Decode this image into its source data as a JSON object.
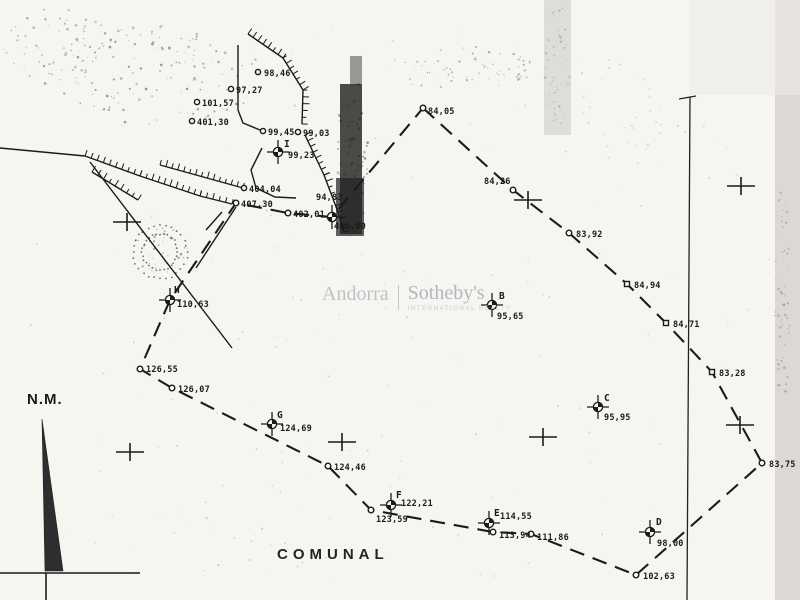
{
  "labels": {
    "north": "N.M.",
    "comunal": "COMUNAL"
  },
  "watermark": {
    "left": "Andorra",
    "right": "Sotheby's",
    "sub": "INTERNATIONAL REALTY"
  },
  "colors": {
    "paper": "#f7f5f0",
    "ink": "#1b1b1b",
    "watermark_gray": "#b6bac4",
    "scan_band_gray": "#d7d5d1",
    "fold_dark": "#1f1f1f"
  },
  "plan": {
    "stations": [
      {
        "id": "I",
        "x": 278,
        "y": 152,
        "lx": 284,
        "ly": 147,
        "value": "99,23",
        "vx": 288,
        "vy": 158
      },
      {
        "id": "B",
        "x": 492,
        "y": 305,
        "lx": 499,
        "ly": 299,
        "value": "95,65",
        "vx": 497,
        "vy": 319
      },
      {
        "id": "C",
        "x": 598,
        "y": 407,
        "lx": 604,
        "ly": 401,
        "value": "95,95",
        "vx": 604,
        "vy": 420
      },
      {
        "id": "D",
        "x": 650,
        "y": 532,
        "lx": 656,
        "ly": 525,
        "value": "98,00",
        "vx": 657,
        "vy": 546
      },
      {
        "id": "E",
        "x": 489,
        "y": 523,
        "lx": 494,
        "ly": 516,
        "value": "114,55",
        "vx": 500,
        "vy": 519
      },
      {
        "id": "F",
        "x": 391,
        "y": 505,
        "lx": 396,
        "ly": 498,
        "value": "122,21",
        "vx": 401,
        "vy": 506
      },
      {
        "id": "G",
        "x": 272,
        "y": 424,
        "lx": 277,
        "ly": 418,
        "value": "124,69",
        "vx": 280,
        "vy": 431
      },
      {
        "id": "H",
        "x": 170,
        "y": 300,
        "lx": 174,
        "ly": 293,
        "value": "110,63",
        "vx": 177,
        "vy": 307
      }
    ],
    "unlettered_station": {
      "x": 332,
      "y": 217,
      "value_above": "94,83",
      "ax": 316,
      "ay": 200,
      "value_below": "460,00",
      "bx": 334,
      "by": 229
    },
    "spot_heights": [
      {
        "x": 258,
        "y": 72,
        "value": "98,46",
        "tx": 264,
        "ty": 76
      },
      {
        "x": 231,
        "y": 89,
        "value": "97,27",
        "tx": 236,
        "ty": 93
      },
      {
        "x": 197,
        "y": 102,
        "value": "101,57",
        "tx": 202,
        "ty": 106
      },
      {
        "x": 192,
        "y": 121,
        "value": "401,30",
        "tx": 197,
        "ty": 125
      },
      {
        "x": 263,
        "y": 131,
        "value": "99,45",
        "tx": 268,
        "ty": 135
      },
      {
        "x": 298,
        "y": 132,
        "value": "99,03",
        "tx": 303,
        "ty": 136
      },
      {
        "x": 244,
        "y": 188,
        "value": "404,04",
        "tx": 249,
        "ty": 192
      }
    ],
    "boundary": {
      "dash": "15 9",
      "vertices": [
        {
          "x": 423,
          "y": 108,
          "m": "c",
          "label": "84,05",
          "tx": 428,
          "ty": 114
        },
        {
          "x": 513,
          "y": 190,
          "m": "c",
          "label": "84,26",
          "tx": 484,
          "ty": 184
        },
        {
          "x": 569,
          "y": 233,
          "m": "c",
          "label": "83,92",
          "tx": 576,
          "ty": 237
        },
        {
          "x": 627,
          "y": 284,
          "m": "s",
          "label": "84,94",
          "tx": 634,
          "ty": 288
        },
        {
          "x": 666,
          "y": 323,
          "m": "s",
          "label": "84,71",
          "tx": 673,
          "ty": 327
        },
        {
          "x": 712,
          "y": 372,
          "m": "s",
          "label": "83,28",
          "tx": 719,
          "ty": 376
        },
        {
          "x": 762,
          "y": 463,
          "m": "c",
          "label": "83,75",
          "tx": 769,
          "ty": 467
        },
        {
          "x": 636,
          "y": 575,
          "m": "c",
          "label": "102,63",
          "tx": 643,
          "ty": 579
        },
        {
          "x": 531,
          "y": 534,
          "m": "c",
          "label": "111,86",
          "tx": 537,
          "ty": 540
        },
        {
          "x": 493,
          "y": 532,
          "m": "c",
          "label": "113,94",
          "tx": 499,
          "ty": 538
        },
        {
          "x": 371,
          "y": 510,
          "m": "c",
          "label": "123,59",
          "tx": 376,
          "ty": 522
        },
        {
          "x": 328,
          "y": 466,
          "m": "c",
          "label": "124,46",
          "tx": 334,
          "ty": 470
        },
        {
          "x": 172,
          "y": 388,
          "m": "c",
          "label": "126,07",
          "tx": 178,
          "ty": 392
        },
        {
          "x": 140,
          "y": 369,
          "m": "c",
          "label": "126,55",
          "tx": 146,
          "ty": 372
        },
        {
          "x": 170,
          "y": 300,
          "m": "n"
        },
        {
          "x": 236,
          "y": 203,
          "m": "c",
          "label": "407,30",
          "tx": 241,
          "ty": 207
        },
        {
          "x": 288,
          "y": 213,
          "m": "c",
          "label": "402,01",
          "tx": 293,
          "ty": 217
        },
        {
          "x": 332,
          "y": 217,
          "m": "n"
        }
      ]
    },
    "grid_crosses": [
      [
        528,
        200
      ],
      [
        741,
        186
      ],
      [
        740,
        425
      ],
      [
        543,
        437
      ],
      [
        342,
        442
      ],
      [
        130,
        452
      ],
      [
        127,
        222
      ]
    ],
    "terrain_hatched": [
      {
        "pts": [
          [
            248,
            34
          ],
          [
            283,
            58
          ],
          [
            303,
            90
          ],
          [
            302,
            124
          ]
        ]
      },
      {
        "pts": [
          [
            85,
            156
          ],
          [
            140,
            176
          ],
          [
            200,
            196
          ],
          [
            232,
            204
          ]
        ]
      },
      {
        "pts": [
          [
            160,
            165
          ],
          [
            243,
            188
          ]
        ]
      },
      {
        "pts": [
          [
            305,
            135
          ],
          [
            324,
            175
          ],
          [
            338,
            212
          ],
          [
            344,
            232
          ]
        ]
      },
      {
        "pts": [
          [
            92,
            172
          ],
          [
            138,
            200
          ]
        ]
      }
    ],
    "terrain_plain": [
      {
        "pts": [
          [
            238,
            45
          ],
          [
            238,
            110
          ],
          [
            243,
            123
          ],
          [
            260,
            130
          ]
        ]
      },
      {
        "pts": [
          [
            90,
            162
          ],
          [
            232,
            348
          ]
        ]
      },
      {
        "pts": [
          [
            262,
            148
          ],
          [
            251,
            170
          ],
          [
            256,
            188
          ],
          [
            275,
            197
          ],
          [
            296,
            198
          ]
        ]
      },
      {
        "pts": [
          [
            0,
            148
          ],
          [
            85,
            156
          ]
        ]
      },
      {
        "pts": [
          [
            236,
            207
          ],
          [
            196,
            268
          ]
        ]
      },
      {
        "pts": [
          [
            222,
            212
          ],
          [
            206,
            230
          ]
        ]
      }
    ],
    "fold_line": {
      "pts": [
        [
          690,
          97
        ],
        [
          687,
          600
        ]
      ],
      "tick": [
        [
          679,
          99
        ],
        [
          696,
          96
        ]
      ]
    },
    "frame_lines": [
      [
        0,
        573,
        140,
        573
      ],
      [
        46,
        573,
        46,
        600
      ]
    ],
    "north_arrow": {
      "triangle": [
        [
          42,
          419
        ],
        [
          45,
          571
        ],
        [
          63,
          571
        ]
      ]
    },
    "vegetation_rings": {
      "cx": 160,
      "cy": 252,
      "radii": [
        18,
        27
      ]
    },
    "scan_rects": [
      {
        "x": 775,
        "y": 0,
        "w": 25,
        "h": 600,
        "c": "#d7d5d1",
        "o": 0.9
      },
      {
        "x": 690,
        "y": 0,
        "w": 110,
        "h": 95,
        "c": "#edebe7",
        "o": 0.6
      },
      {
        "x": 544,
        "y": 0,
        "w": 27,
        "h": 135,
        "c": "#ccc9c4",
        "o": 0.55
      },
      {
        "x": 340,
        "y": 84,
        "w": 22,
        "h": 150,
        "c": "#1f1f1f",
        "o": 0.8
      },
      {
        "x": 336,
        "y": 178,
        "w": 28,
        "h": 58,
        "c": "#242424",
        "o": 0.72
      },
      {
        "x": 350,
        "y": 56,
        "w": 12,
        "h": 30,
        "c": "#3a3a3a",
        "o": 0.5
      }
    ],
    "noise_clusters": [
      {
        "cx": 150,
        "cy": 75,
        "rx": 115,
        "ry": 50,
        "n": 130,
        "c": "#333333",
        "o": 0.5,
        "s": 1.2
      },
      {
        "cx": 55,
        "cy": 45,
        "rx": 55,
        "ry": 38,
        "n": 55,
        "c": "#444444",
        "o": 0.45,
        "s": 1.1
      },
      {
        "cx": 460,
        "cy": 68,
        "rx": 75,
        "ry": 22,
        "n": 70,
        "c": "#555555",
        "o": 0.5,
        "s": 1.1
      },
      {
        "cx": 352,
        "cy": 160,
        "rx": 16,
        "ry": 85,
        "n": 90,
        "c": "#222222",
        "o": 0.5,
        "s": 1.3
      },
      {
        "cx": 557,
        "cy": 65,
        "rx": 13,
        "ry": 62,
        "n": 45,
        "c": "#888888",
        "o": 0.5,
        "s": 1.2
      },
      {
        "cx": 782,
        "cy": 300,
        "rx": 8,
        "ry": 115,
        "n": 55,
        "c": "#777777",
        "o": 0.55,
        "s": 1.2
      },
      {
        "cx": 400,
        "cy": 300,
        "rx": 390,
        "ry": 290,
        "n": 160,
        "c": "#666666",
        "o": 0.3,
        "s": 0.9
      },
      {
        "cx": 160,
        "cy": 252,
        "rx": 28,
        "ry": 26,
        "n": 40,
        "c": "#333333",
        "o": 0.5,
        "s": 1.1
      },
      {
        "cx": 620,
        "cy": 120,
        "rx": 80,
        "ry": 55,
        "n": 35,
        "c": "#888888",
        "o": 0.4,
        "s": 1.0
      },
      {
        "cx": 200,
        "cy": 530,
        "rx": 160,
        "ry": 50,
        "n": 30,
        "c": "#666666",
        "o": 0.35,
        "s": 1.0
      }
    ]
  }
}
